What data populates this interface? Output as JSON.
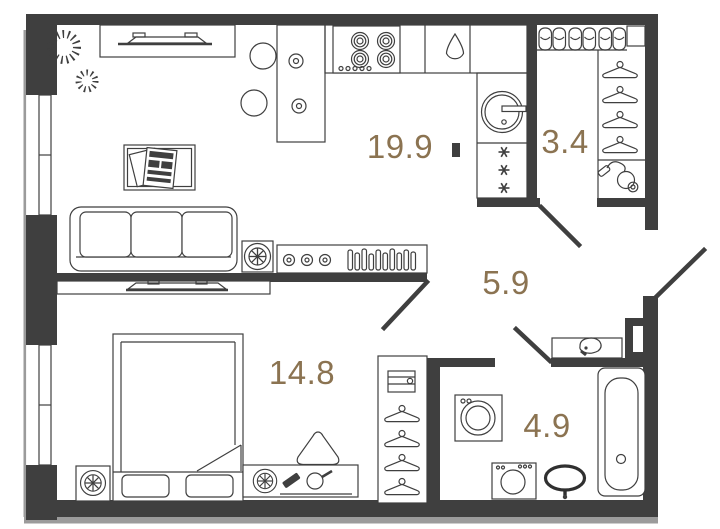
{
  "page": {
    "background": "#ffffff",
    "width": 720,
    "height": 529
  },
  "palette": {
    "wall": "#3f3f3f",
    "furniture_line": "#3f3f3f",
    "outer_trim": "#9b9b9b",
    "room_label": "#8b7351"
  },
  "plan": {
    "rooms": [
      {
        "name": "kitchen-living-room",
        "area": "19.9"
      },
      {
        "name": "wardrobe-room",
        "area": "3.4"
      },
      {
        "name": "hallway",
        "area": "5.9"
      },
      {
        "name": "bedroom",
        "area": "14.8"
      },
      {
        "name": "bathroom",
        "area": "4.9"
      }
    ],
    "icons": [
      "plant",
      "tv",
      "tv-cabinet",
      "dining-table",
      "chair",
      "plate",
      "stove-burners",
      "kitchen-sink-drop",
      "washing-machine",
      "fridge-snowflakes",
      "wall-art",
      "sofa",
      "table-lamp",
      "media-console",
      "vinyl-records",
      "slippers",
      "coat-hanger",
      "vacuum-cleaner",
      "hall-console-bowl",
      "bed",
      "pillow",
      "nightstand",
      "dresser",
      "hand-mirror",
      "brush",
      "pouf",
      "wardrobe-storage-box",
      "toilet",
      "bathroom-sink",
      "bathtub",
      "door-swing",
      "window"
    ]
  }
}
